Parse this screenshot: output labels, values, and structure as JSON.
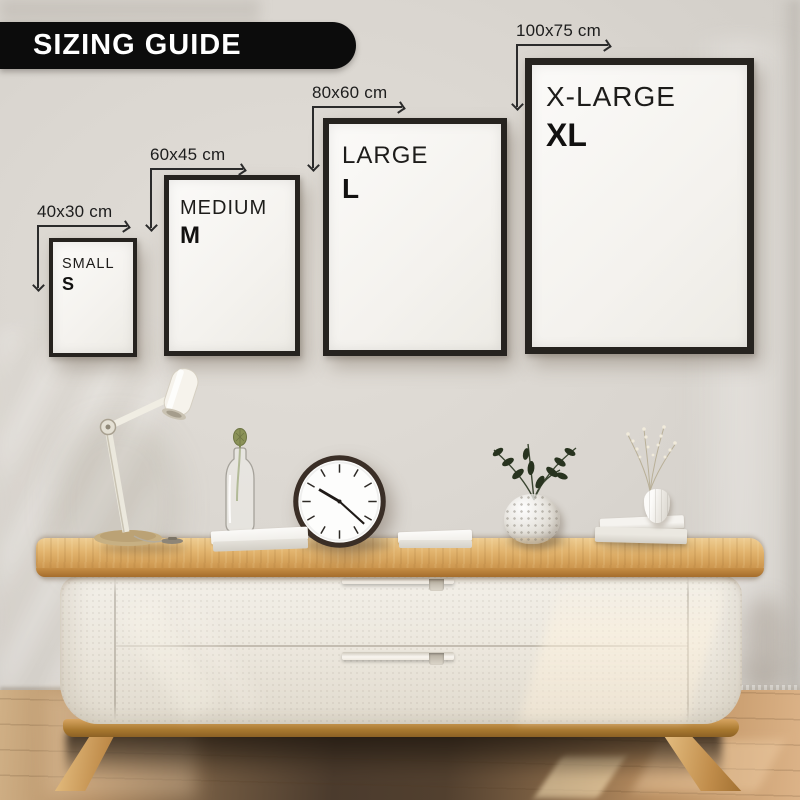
{
  "banner": {
    "label": "SIZING GUIDE",
    "bg_color": "#0c0c0c",
    "text_color": "#ffffff"
  },
  "sizes": [
    {
      "dimension": "40x30 cm",
      "name": "SMALL",
      "abbr": "S"
    },
    {
      "dimension": "60x45 cm",
      "name": "MEDIUM",
      "abbr": "M"
    },
    {
      "dimension": "80x60 cm",
      "name": "LARGE",
      "abbr": "L"
    },
    {
      "dimension": "100x75 cm",
      "name": "X-LARGE",
      "abbr": "XL"
    }
  ],
  "scene": {
    "objects": [
      "desk-lamp-icon",
      "bud-vase-bottle-icon",
      "wall-clock-icon",
      "book-icon",
      "book-icon",
      "bubble-glass-vase-icon",
      "book-stack-icon",
      "dried-flowers-vase-icon",
      "sideboard-icon"
    ],
    "clock_time_depicted": "10:22"
  },
  "colors": {
    "frame": "#26231f",
    "wall": "#d9d5d0",
    "wood_top": "#d39c55",
    "cabinet_body": "#ece8df",
    "floor_dark": "#4b3b2d",
    "floor_light": "#d0b086",
    "dimension_lines": "#2b2b2b"
  }
}
